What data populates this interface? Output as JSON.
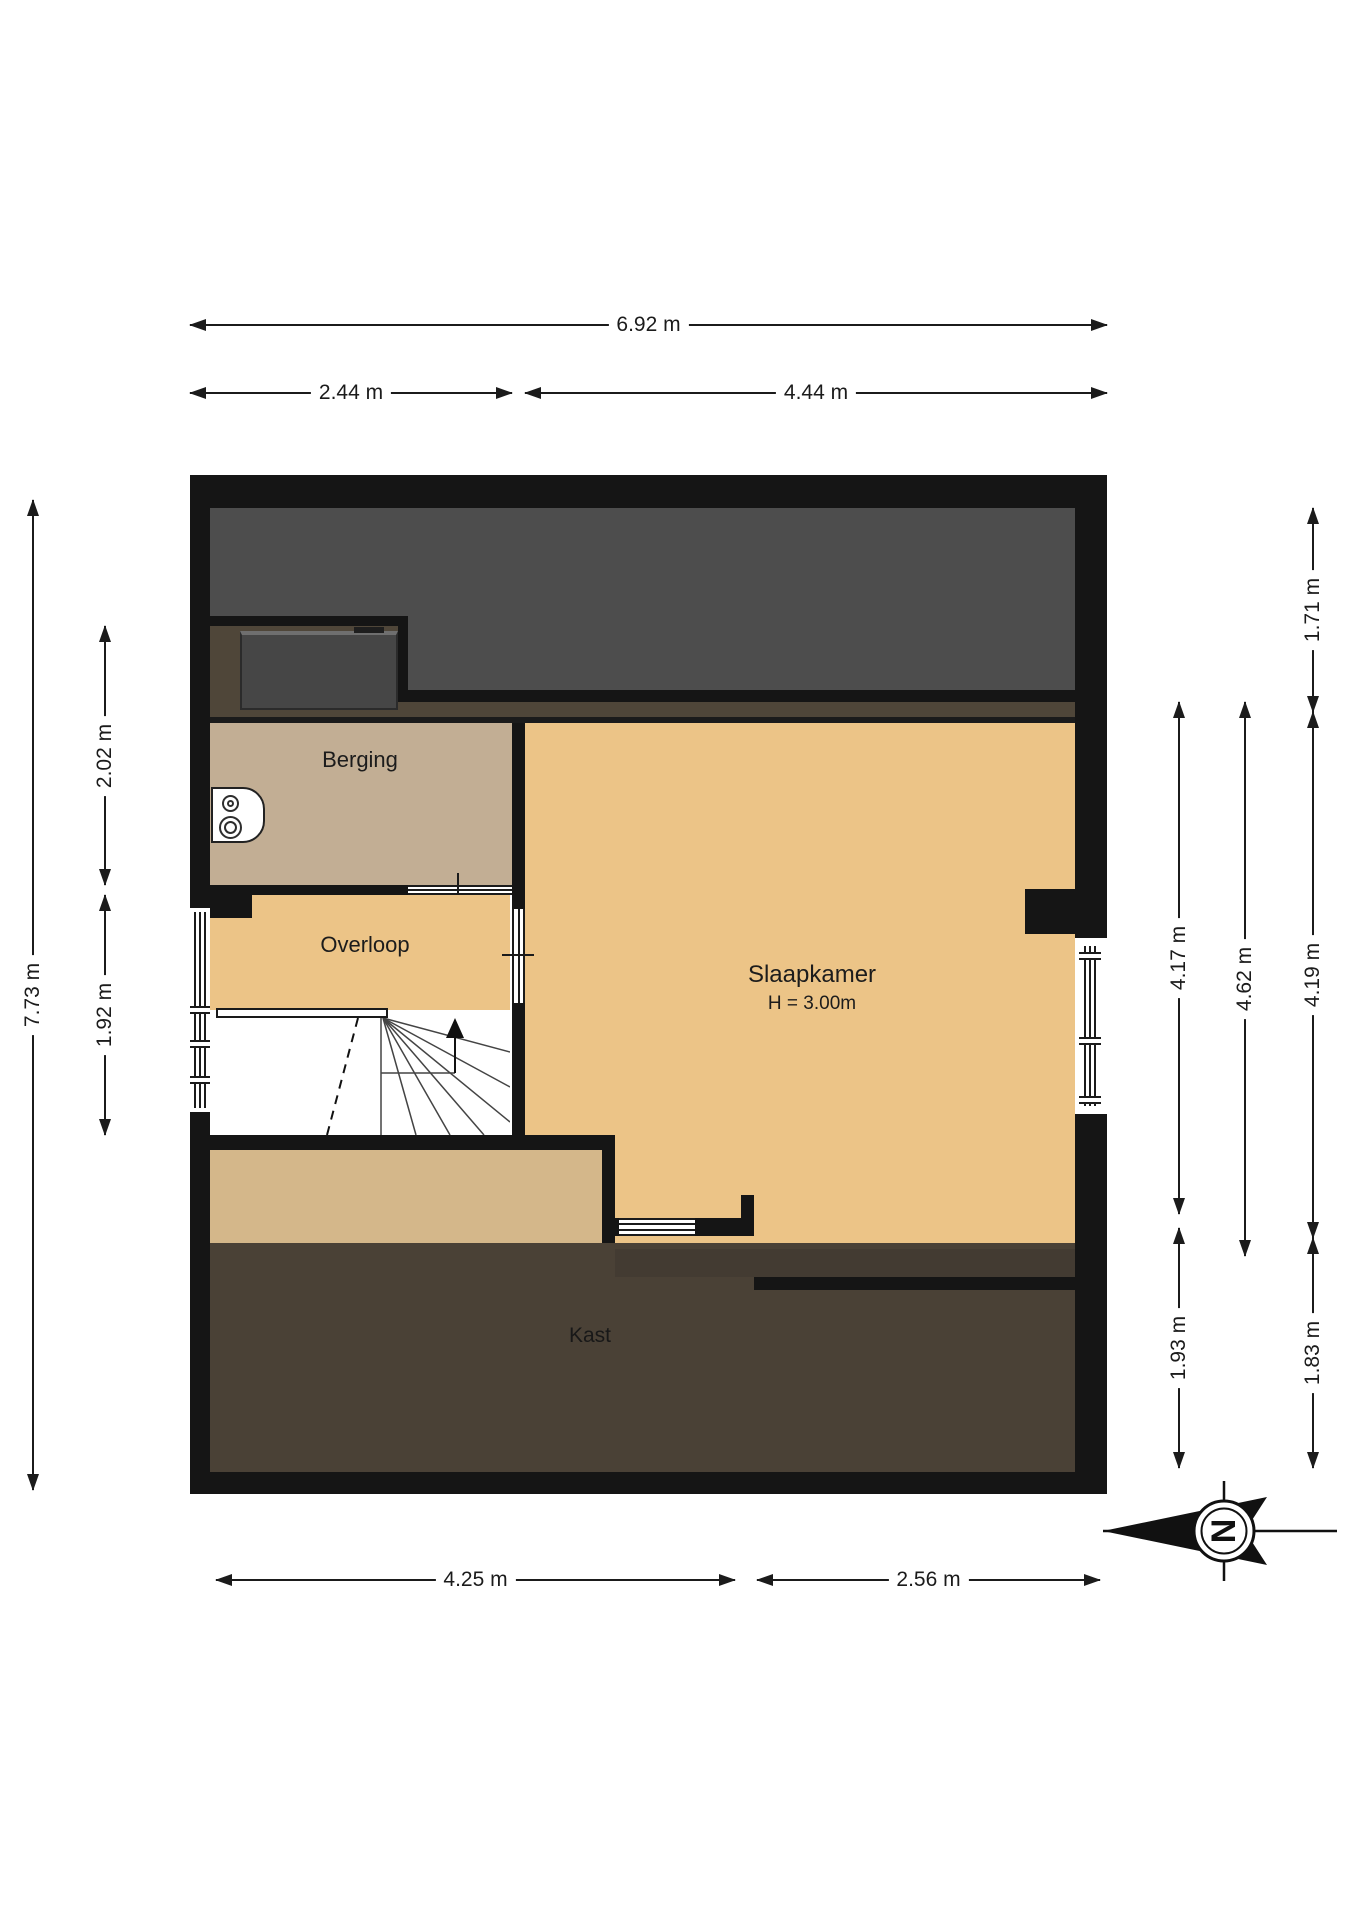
{
  "rooms": {
    "berging": {
      "label": "Berging"
    },
    "overloop": {
      "label": "Overloop"
    },
    "slaapkamer": {
      "label": "Slaapkamer",
      "height_note": "H = 3.00m"
    },
    "kast": {
      "label": "Kast"
    }
  },
  "dimensions": {
    "top": {
      "total": "6.92 m",
      "left": "2.44 m",
      "right": "4.44 m"
    },
    "bottom": {
      "left": "4.25 m",
      "right": "2.56 m"
    },
    "left": {
      "total": "7.73 m",
      "upper": "2.02 m",
      "lower": "1.92 m"
    },
    "right": {
      "col1_upper": "4.17 m",
      "col1_lower": "1.93 m",
      "col2": "4.62 m",
      "col3_upper": "1.71 m",
      "col3_mid": "4.19 m",
      "col3_lower": "1.83 m"
    }
  },
  "compass": {
    "north_label": "N"
  },
  "colors": {
    "wall": "#151515",
    "roof_void": "#4d4d4d",
    "under_roof_strip": "#4f4639",
    "berging_floor": "#c2ae94",
    "room_floor": "#ecc487",
    "landing_strip_floor": "#d4b78a",
    "kast_floor": "#4a4136"
  }
}
